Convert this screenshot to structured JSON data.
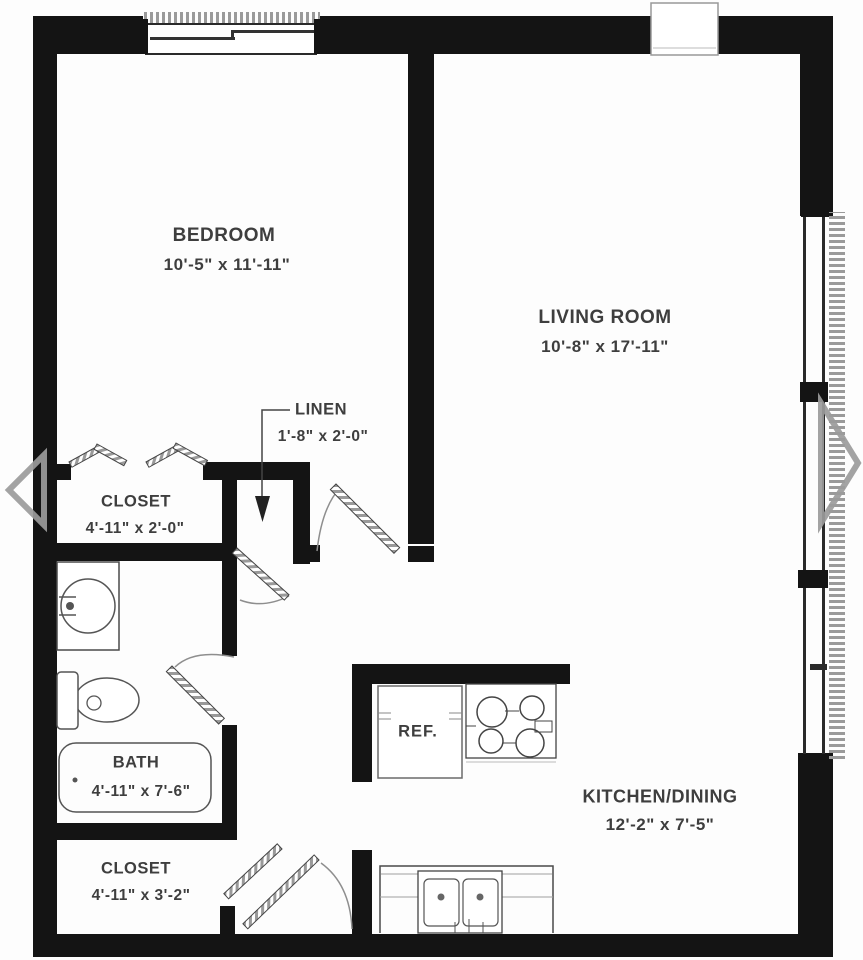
{
  "colors": {
    "wall": "#141414",
    "line": "#4a4a4a",
    "thin": "#777777",
    "text": "#3e3e3e",
    "hatch": "#9a9a9a",
    "arrow": "#9b9b9b",
    "paper": "#fdfdfd"
  },
  "rooms": [
    {
      "name": "BEDROOM",
      "dims": "10'-5\" x 11'-11\""
    },
    {
      "name": "LIVING ROOM",
      "dims": "10'-8\" x 17'-11\""
    },
    {
      "name": "LINEN",
      "dims": "1'-8\" x 2'-0\""
    },
    {
      "name": "CLOSET",
      "dims": "4'-11\" x 2'-0\""
    },
    {
      "name": "BATH",
      "dims": "4'-11\" x 7'-6\""
    },
    {
      "name": "CLOSET",
      "dims": "4'-11\" x 3'-2\""
    },
    {
      "name": "KITCHEN/DINING",
      "dims": "12'-2\" x 7'-5\""
    }
  ],
  "appliances": {
    "refrigerator": "REF."
  },
  "fixtures": [
    "bathroom-sink",
    "toilet",
    "bathtub",
    "bifold-closet-doors",
    "door-swings",
    "refrigerator",
    "range-burners",
    "kitchen-double-sink",
    "sliding-window",
    "side-windows",
    "linen-pointer-arrow"
  ],
  "nav": {
    "previous": "carousel-previous-arrow",
    "next": "carousel-next-arrow"
  }
}
